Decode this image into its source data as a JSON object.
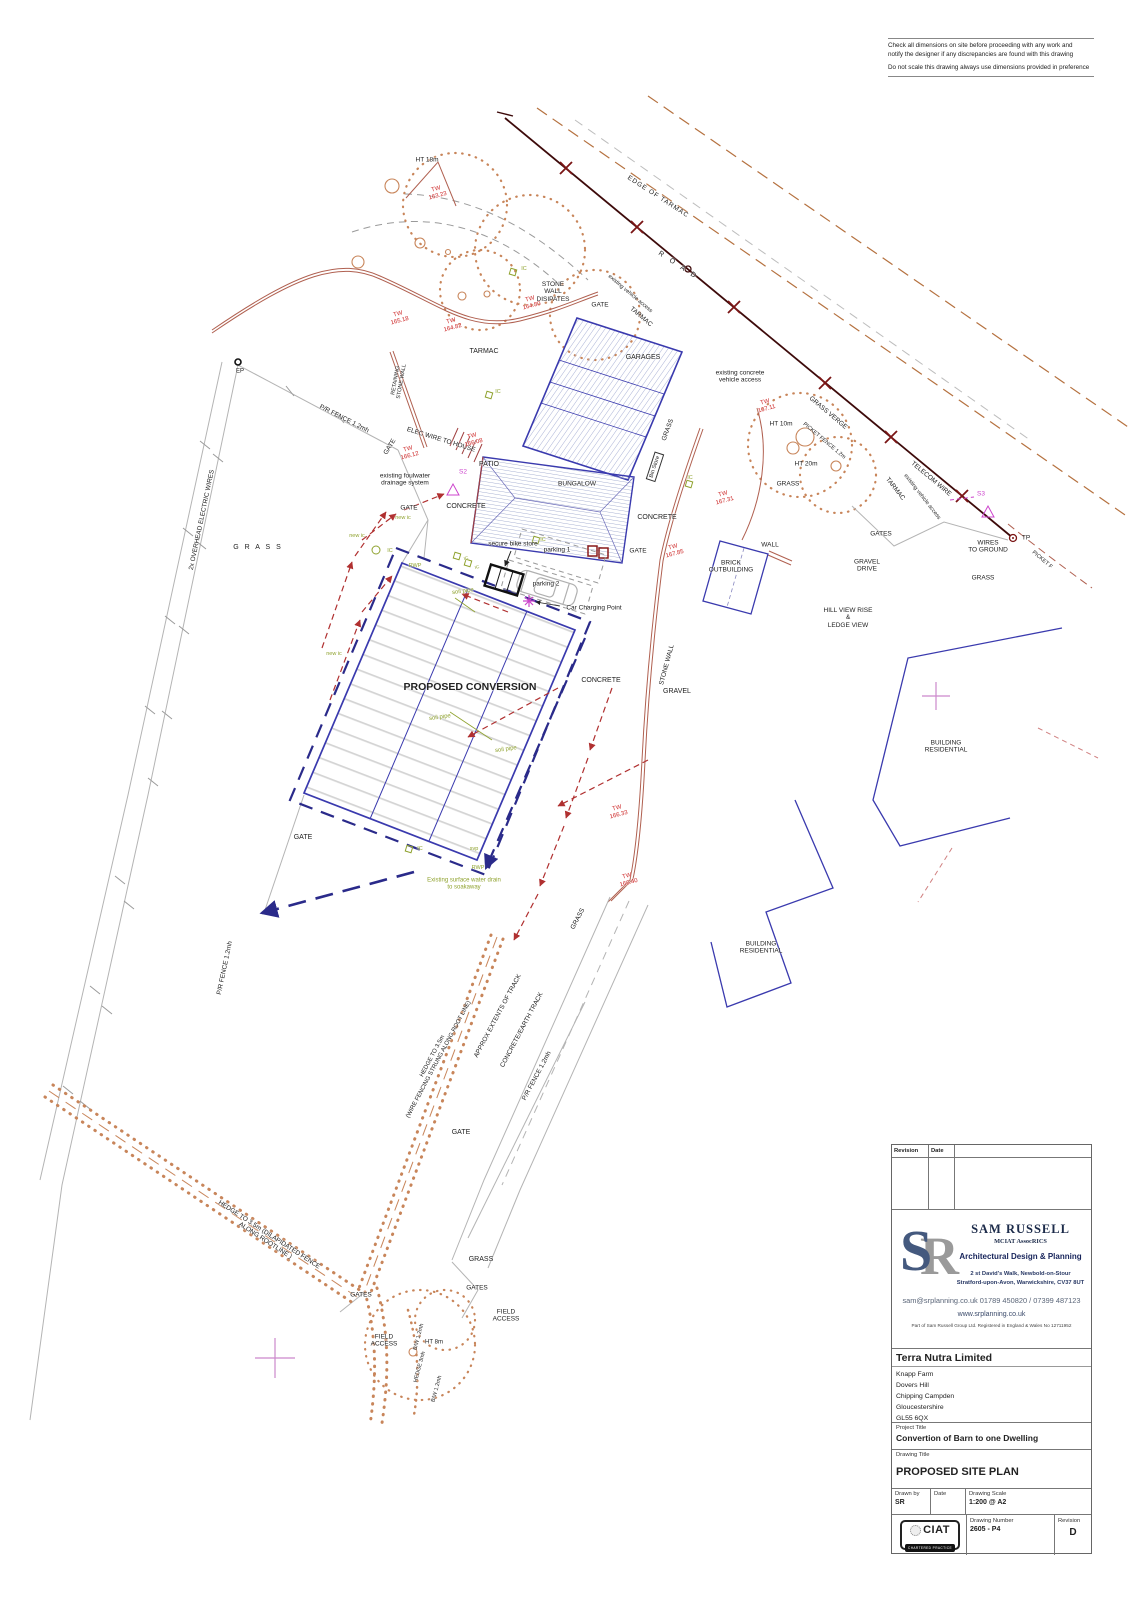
{
  "notes": {
    "line1": "Check all dimensions on site before proceeding with any work and\nnotify the designer if any discrepancies are found with this drawing",
    "line2": "Do not scale this drawing always use dimensions provided in preference"
  },
  "title_block": {
    "revision_header": {
      "revision": "Revision",
      "date": "Date"
    },
    "firm": {
      "monogram_s": "S",
      "monogram_r": "R",
      "name": "SAM RUSSELL",
      "credentials": "MCIAT AssocRICS",
      "tagline": "Architectural Design & Planning",
      "address1": "2 st David's Walk, Newbold-on-Stour",
      "address2": "Stratford-upon-Avon, Warwickshire, CV37 8UT",
      "contact": "sam@srplanning.co.uk 01789 450820 / 07399 487123",
      "website": "www.srplanning.co.uk",
      "registration": "Part of Sam Russell Group Ltd. Registered in England &  Wales No 12711952"
    },
    "client": {
      "name": "Terra Nutra Limited",
      "address_lines": [
        "Knapp Farm",
        "Dovers Hill",
        "Chipping Campden",
        "Gloucestershire",
        "GL55 6QX"
      ]
    },
    "project": {
      "label": "Project Title",
      "title": "Convertion of Barn to one Dwelling"
    },
    "drawing": {
      "label": "Drawing Title",
      "title": "PROPOSED SITE PLAN"
    },
    "meta": {
      "drawn_by_label": "Drawn by",
      "drawn_by": "SR",
      "date_label": "Date",
      "date": "",
      "scale_label": "Drawing Scale",
      "scale": "1:200  @ A2",
      "number_label": "Drawing Number",
      "number": "2605 - P4",
      "revision_label": "Revision",
      "revision": "D"
    },
    "ciat": {
      "name": "CIAT",
      "subtitle": "CHARTERED PRACTICE"
    }
  },
  "plan": {
    "colors": {
      "black": "#222222",
      "red": "#cc2222",
      "olive": "#8fa22e",
      "magenta": "#cc44cc",
      "brown": "#b5713f",
      "navy": "#2a2a8a"
    },
    "labels": [
      {
        "id": "ht-18m",
        "t": "HT 18m",
        "x": 427,
        "y": 160,
        "s": 6.5
      },
      {
        "id": "tw-16323",
        "t": "TW\n163.23",
        "x": 437,
        "y": 193,
        "r": -15,
        "c": "red",
        "s": 6
      },
      {
        "id": "edge-of-tarmac",
        "t": "EDGE OF TARMAC",
        "x": 658,
        "y": 197,
        "r": 33,
        "s": 6.5,
        "ls": 1
      },
      {
        "id": "road",
        "t": "R O A D",
        "x": 678,
        "y": 266,
        "r": 33,
        "s": 7,
        "ls": 3
      },
      {
        "id": "stone-wall-disipates",
        "t": "STONE\nWALL\nDISIPATES",
        "x": 553,
        "y": 292,
        "s": 6.5
      },
      {
        "id": "existing-vehicle-access-top",
        "t": "existing vehicle access",
        "x": 630,
        "y": 294,
        "r": 40,
        "s": 5.5
      },
      {
        "id": "tarmac-top",
        "t": "TARMAC",
        "x": 641,
        "y": 317,
        "r": 40,
        "s": 6.5
      },
      {
        "id": "gate-top",
        "t": "GATE",
        "x": 600,
        "y": 305,
        "s": 6.5
      },
      {
        "id": "tarmac-left",
        "t": "TARMAC",
        "x": 484,
        "y": 352,
        "s": 7
      },
      {
        "id": "tw-16518",
        "t": "TW\n165.18",
        "x": 399,
        "y": 318,
        "r": -15,
        "c": "red",
        "s": 6
      },
      {
        "id": "tw-16482",
        "t": "TW\n164.82",
        "x": 452,
        "y": 325,
        "r": -15,
        "c": "red",
        "s": 6
      },
      {
        "id": "tw-16480",
        "t": "TW\n164.80",
        "x": 531,
        "y": 303,
        "r": -15,
        "c": "red",
        "s": 6
      },
      {
        "id": "garages",
        "t": "GARAGES",
        "x": 643,
        "y": 358,
        "s": 7
      },
      {
        "id": "grass-garages",
        "t": "GRASS",
        "x": 668,
        "y": 430,
        "r": -70,
        "s": 6.5
      },
      {
        "id": "bin-store",
        "t": "Bin Store",
        "x": 655,
        "y": 467,
        "r": -72,
        "s": 5.5,
        "box": true
      },
      {
        "id": "existing-concrete-vehicle-access",
        "t": "existing concrete\nvehicle access",
        "x": 740,
        "y": 377,
        "s": 6.5
      },
      {
        "id": "tw-16711",
        "t": "TW\n167.11",
        "x": 766,
        "y": 406,
        "r": -15,
        "c": "red",
        "s": 6
      },
      {
        "id": "ht-10m",
        "t": "HT 10m",
        "x": 781,
        "y": 424,
        "s": 6.5
      },
      {
        "id": "ht-20m",
        "t": "HT 20m",
        "x": 806,
        "y": 464,
        "s": 6.5
      },
      {
        "id": "grass-right",
        "t": "GRASS",
        "x": 788,
        "y": 484,
        "s": 6.5
      },
      {
        "id": "grass-verge",
        "t": "GRASS VERGE",
        "x": 828,
        "y": 413,
        "r": 40,
        "s": 6.5
      },
      {
        "id": "picket-fence-12m",
        "t": "PICKET FENCE 1.2m",
        "x": 824,
        "y": 441,
        "r": 40,
        "s": 5.5
      },
      {
        "id": "telecom-wire",
        "t": "TELECOM WIRE",
        "x": 931,
        "y": 479,
        "r": 40,
        "s": 6.5
      },
      {
        "id": "tarmac-right",
        "t": "TARMAC",
        "x": 895,
        "y": 489,
        "r": 52,
        "s": 6.5
      },
      {
        "id": "existing-vehicle-access-right",
        "t": "existing vehicle access",
        "x": 922,
        "y": 497,
        "r": 52,
        "s": 5.5
      },
      {
        "id": "s3",
        "t": "S3",
        "x": 981,
        "y": 494,
        "c": "magenta",
        "s": 6.5
      },
      {
        "id": "tp",
        "t": "TP",
        "x": 1026,
        "y": 538,
        "s": 6.5
      },
      {
        "id": "wires-to-ground",
        "t": "WIRES\nTO GROUND",
        "x": 988,
        "y": 547,
        "s": 6.5
      },
      {
        "id": "picket-fence-right",
        "t": "PICKET F",
        "x": 1042,
        "y": 560,
        "r": 40,
        "s": 5.5
      },
      {
        "id": "gates-right",
        "t": "GATES",
        "x": 881,
        "y": 534,
        "s": 6.5
      },
      {
        "id": "gravel-drive",
        "t": "GRAVEL\nDRIVE",
        "x": 867,
        "y": 566,
        "s": 6.5
      },
      {
        "id": "grass-far-right",
        "t": "GRASS",
        "x": 983,
        "y": 578,
        "s": 6.5
      },
      {
        "id": "wall",
        "t": "WALL",
        "x": 770,
        "y": 545,
        "s": 6.5
      },
      {
        "id": "brick-outbuilding",
        "t": "BRICK\nOUTBUILDING",
        "x": 731,
        "y": 567,
        "s": 6.5
      },
      {
        "id": "hill-view",
        "t": "HILL VIEW RISE\n&\nLEDGE VIEW",
        "x": 848,
        "y": 618,
        "s": 6.5
      },
      {
        "id": "tw-16731",
        "t": "TW\n167.31",
        "x": 724,
        "y": 498,
        "r": -15,
        "c": "red",
        "s": 6
      },
      {
        "id": "concrete-mid",
        "t": "CONCRETE",
        "x": 657,
        "y": 518,
        "s": 7
      },
      {
        "id": "gate-wall",
        "t": "GATE",
        "x": 638,
        "y": 551,
        "s": 6.5
      },
      {
        "id": "tw-16785",
        "t": "TW\n167.85",
        "x": 674,
        "y": 551,
        "r": -15,
        "c": "red",
        "s": 6
      },
      {
        "id": "stone-wall-label",
        "t": "STONE WALL",
        "x": 667,
        "y": 665,
        "r": -75,
        "s": 6.5
      },
      {
        "id": "gravel",
        "t": "GRAVEL",
        "x": 677,
        "y": 692,
        "s": 7
      },
      {
        "id": "concrete-conv",
        "t": "CONCRETE",
        "x": 601,
        "y": 681,
        "s": 7
      },
      {
        "id": "proposed-conversion",
        "t": "PROPOSED CONVERSION",
        "x": 470,
        "y": 688,
        "s": 10.5,
        "w": 1
      },
      {
        "id": "elec-wire-to-house",
        "t": "ELEC WIRE TO HOUSE",
        "x": 441,
        "y": 440,
        "r": 17,
        "s": 6.5
      },
      {
        "id": "tw-16608",
        "t": "TW\n166.08",
        "x": 473,
        "y": 440,
        "r": -15,
        "c": "red",
        "s": 6
      },
      {
        "id": "tw-16612",
        "t": "TW\n166.12",
        "x": 409,
        "y": 453,
        "r": -15,
        "c": "red",
        "s": 6
      },
      {
        "id": "gate-rot",
        "t": "GATE",
        "x": 390,
        "y": 447,
        "r": -58,
        "s": 6.5
      },
      {
        "id": "existing-foulwater",
        "t": "existing foulwater\ndrainage system",
        "x": 405,
        "y": 480,
        "s": 6.5
      },
      {
        "id": "gate-mid",
        "t": "GATE",
        "x": 409,
        "y": 508,
        "s": 6.5
      },
      {
        "id": "new-ic-1",
        "t": "new ic",
        "x": 403,
        "y": 518,
        "c": "olive",
        "s": 5.5
      },
      {
        "id": "new-ic-2",
        "t": "new ic",
        "x": 357,
        "y": 536,
        "c": "olive",
        "s": 5.5
      },
      {
        "id": "new-ic-3",
        "t": "new ic",
        "x": 334,
        "y": 654,
        "c": "olive",
        "s": 5.5
      },
      {
        "id": "patio",
        "t": "PATIO",
        "x": 489,
        "y": 465,
        "s": 7
      },
      {
        "id": "s2",
        "t": "S2",
        "x": 463,
        "y": 472,
        "c": "magenta",
        "s": 6.5
      },
      {
        "id": "concrete-patio",
        "t": "CONCRETE",
        "x": 466,
        "y": 507,
        "s": 7
      },
      {
        "id": "bungalow",
        "t": "BUNGALOW",
        "x": 577,
        "y": 484,
        "s": 6.5
      },
      {
        "id": "secure-bike-store",
        "t": "secure bike store",
        "x": 513,
        "y": 544,
        "s": 6.5
      },
      {
        "id": "parking-1",
        "t": "parking 1",
        "x": 557,
        "y": 550,
        "s": 6.5
      },
      {
        "id": "parking-2",
        "t": "parking 2",
        "x": 546,
        "y": 584,
        "s": 6.5
      },
      {
        "id": "car-charging-point",
        "t": "Car Charging Point",
        "x": 594,
        "y": 608,
        "s": 6.5
      },
      {
        "id": "soil-pipe-1",
        "t": "soil pipe",
        "x": 463,
        "y": 592,
        "r": -8,
        "c": "olive",
        "s": 6
      },
      {
        "id": "soil-pipe-2",
        "t": "soil pipe",
        "x": 440,
        "y": 718,
        "r": -8,
        "c": "olive",
        "s": 6
      },
      {
        "id": "soil-pipe-3",
        "t": "soil pipe",
        "x": 506,
        "y": 750,
        "r": -8,
        "c": "olive",
        "s": 6
      },
      {
        "id": "svp",
        "t": "svp",
        "x": 474,
        "y": 849,
        "c": "olive",
        "s": 5.5
      },
      {
        "id": "rwp-1",
        "t": "RWP",
        "x": 415,
        "y": 566,
        "c": "olive",
        "s": 5.5
      },
      {
        "id": "rwp-2",
        "t": "RWP",
        "x": 478,
        "y": 868,
        "c": "olive",
        "s": 5.5
      },
      {
        "id": "ic-1",
        "t": "IC",
        "x": 524,
        "y": 269,
        "c": "olive",
        "s": 5.5
      },
      {
        "id": "ic-2",
        "t": "IC",
        "x": 498,
        "y": 392,
        "c": "olive",
        "s": 5.5
      },
      {
        "id": "ic-3",
        "t": "IC",
        "x": 390,
        "y": 551,
        "c": "olive",
        "s": 5.5
      },
      {
        "id": "ic-4",
        "t": "IC",
        "x": 466,
        "y": 558,
        "r": -20,
        "c": "olive",
        "s": 4.5
      },
      {
        "id": "ic-5",
        "t": "IC",
        "x": 477,
        "y": 567,
        "r": -20,
        "c": "olive",
        "s": 4.5
      },
      {
        "id": "ic-6",
        "t": "IC",
        "x": 690,
        "y": 478,
        "c": "olive",
        "s": 5.5
      },
      {
        "id": "ic-7",
        "t": "IC",
        "x": 543,
        "y": 540,
        "c": "olive",
        "s": 5.5
      },
      {
        "id": "ic-8",
        "t": "IC",
        "x": 420,
        "y": 849,
        "c": "olive",
        "s": 5.5
      },
      {
        "id": "existing-surface-water",
        "t": "Existing surface water drain\nto soakaway",
        "x": 464,
        "y": 884,
        "c": "olive",
        "s": 6
      },
      {
        "id": "gate-sw",
        "t": "GATE",
        "x": 303,
        "y": 838,
        "s": 7
      },
      {
        "id": "pr-fence-left",
        "t": "P/R FENCE 1.2mh",
        "x": 225,
        "y": 968,
        "r": -78,
        "s": 6.5
      },
      {
        "id": "pr-fence-top",
        "t": "P/R FENCE 1.2mh",
        "x": 344,
        "y": 419,
        "r": 27,
        "s": 6.5
      },
      {
        "id": "overhead-wires",
        "t": "2x OVERHEAD ELECTRIC WIRES",
        "x": 202,
        "y": 520,
        "r": -78,
        "s": 6.5
      },
      {
        "id": "ep",
        "t": "EP",
        "x": 240,
        "y": 372,
        "s": 6
      },
      {
        "id": "grass-left",
        "t": "G R A S S",
        "x": 258,
        "y": 548,
        "s": 7,
        "ls": 2
      },
      {
        "id": "retaining-stone-wall",
        "t": "RETAINING\nSTONE WALL",
        "x": 399,
        "y": 381,
        "r": -80,
        "s": 5.5
      },
      {
        "id": "building-residential-1",
        "t": "BUILDING\nRESIDENTIAL",
        "x": 946,
        "y": 747,
        "s": 6.5
      },
      {
        "id": "building-residential-2",
        "t": "BUILDING\nRESIDENTIAL",
        "x": 761,
        "y": 948,
        "s": 6.5
      },
      {
        "id": "grass-track",
        "t": "GRASS",
        "x": 578,
        "y": 919,
        "r": -62,
        "s": 6.5
      },
      {
        "id": "approx-extents",
        "t": "APPROX EXTENTS OF TRACK",
        "x": 498,
        "y": 1016,
        "r": -62,
        "s": 6.5
      },
      {
        "id": "concrete-earth-track",
        "t": "CONCRETE/EARTH TRACK",
        "x": 522,
        "y": 1030,
        "r": -62,
        "s": 6.5
      },
      {
        "id": "pr-fence-track",
        "t": "P/R FENCE 1.2mh",
        "x": 537,
        "y": 1076,
        "r": -62,
        "s": 6.5
      },
      {
        "id": "hedge-wire",
        "t": "HEDGE TO 3.5m\n(WIRE FENCING STRUNG ALONG ROOT LINE)",
        "x": 436,
        "y": 1058,
        "r": -62,
        "s": 6
      },
      {
        "id": "hedge-dilapidated",
        "t": "HEDGE TO 3.5m (DILAPIDATED FENCE\nALONG ROOTLINE )",
        "x": 267,
        "y": 1238,
        "r": 33,
        "s": 6.5
      },
      {
        "id": "gate-bottom",
        "t": "GATE",
        "x": 461,
        "y": 1133,
        "s": 7
      },
      {
        "id": "grass-bottom",
        "t": "GRASS",
        "x": 481,
        "y": 1260,
        "s": 7
      },
      {
        "id": "gates-bottom-1",
        "t": "GATES",
        "x": 477,
        "y": 1288,
        "s": 6.5
      },
      {
        "id": "field-access-1",
        "t": "FIELD\nACCESS",
        "x": 506,
        "y": 1316,
        "s": 6.5
      },
      {
        "id": "gates-bottom-2",
        "t": "GATES",
        "x": 361,
        "y": 1295,
        "s": 6.5
      },
      {
        "id": "field-access-2",
        "t": "FIELD\nACCESS",
        "x": 384,
        "y": 1341,
        "s": 6.5
      },
      {
        "id": "bw-fence-1",
        "t": "B/W 1.2mh",
        "x": 419,
        "y": 1337,
        "r": -75,
        "s": 5.5
      },
      {
        "id": "hedge-3m",
        "t": "HEDGE 3mh",
        "x": 420,
        "y": 1367,
        "r": -75,
        "s": 5.5
      },
      {
        "id": "ht-8m",
        "t": "HT 8m",
        "x": 434,
        "y": 1343,
        "s": 6
      },
      {
        "id": "bw-fence-2",
        "t": "B/W 1.2mh",
        "x": 437,
        "y": 1389,
        "r": -75,
        "s": 5.5
      },
      {
        "id": "tw-16633",
        "t": "TW\n166.33",
        "x": 618,
        "y": 812,
        "r": -15,
        "c": "red",
        "s": 6
      },
      {
        "id": "tw-16640",
        "t": "TW\n166.40",
        "x": 628,
        "y": 880,
        "r": -15,
        "c": "red",
        "s": 6
      }
    ]
  }
}
